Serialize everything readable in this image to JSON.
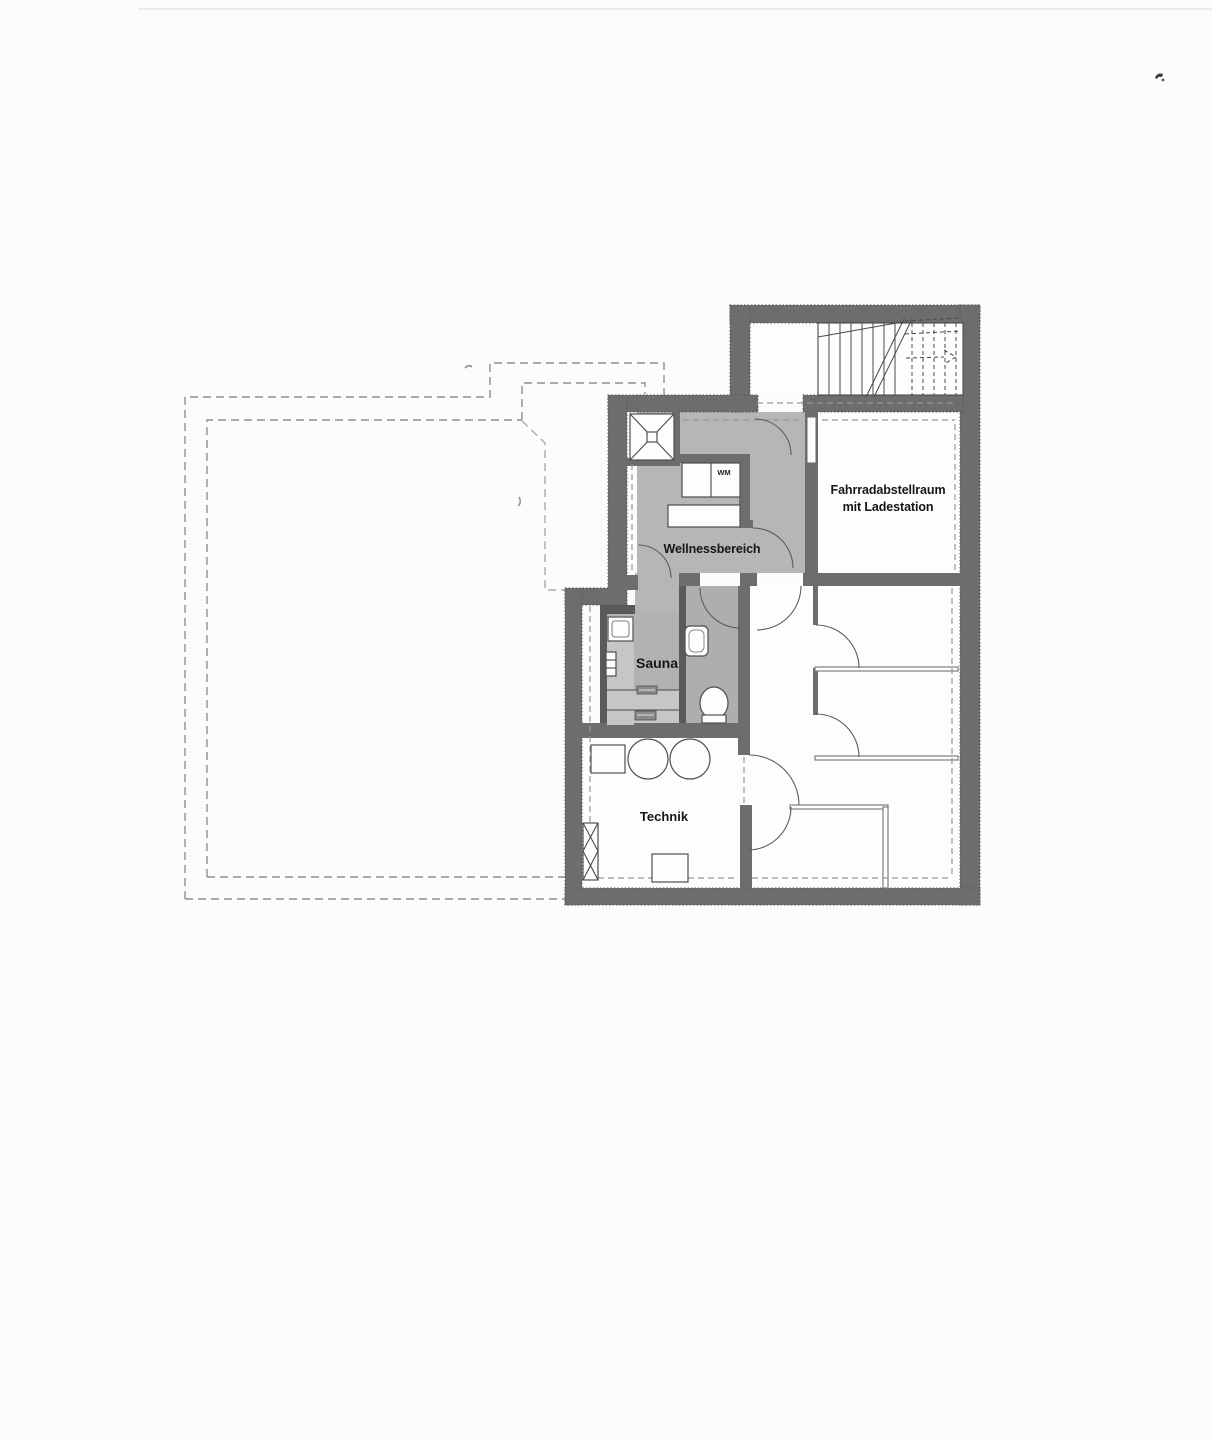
{
  "document": {
    "kind": "scanned basement floor plan"
  },
  "labels": {
    "bike_room_line1": "Fahrradabstellraum",
    "bike_room_line2": "mit Ladestation",
    "wellness_area": "Wellnessbereich",
    "sauna": "Sauna",
    "technik": "Technik",
    "washing_machine": "WM"
  },
  "colors": {
    "wall_gray": "#6d6d6d",
    "room_light_gray": "#b6b6b6",
    "sauna_gray": "#b2b2b2",
    "sauna_bench_gray": "#c6c6c6",
    "wc_gray": "#aeaeae",
    "paper_white": "#fcfcfc",
    "dashed_outline_gray": "#8f8f8f",
    "label_black": "#161616"
  }
}
